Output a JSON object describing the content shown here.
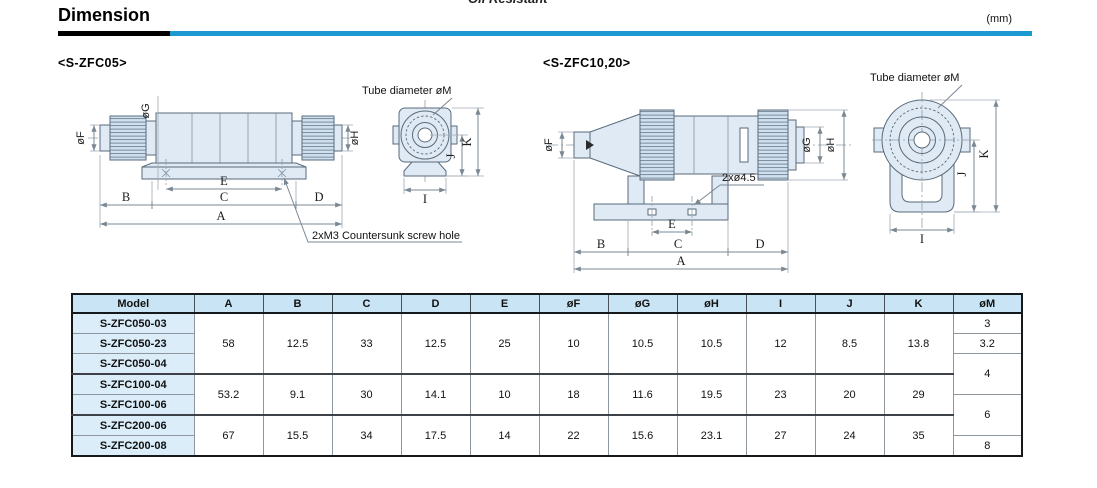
{
  "page": {
    "title": "Dimension",
    "unit": "(mm)",
    "cropped_text": "Oil Resistant"
  },
  "drawings": {
    "left": {
      "title": "<S-ZFC05>",
      "note": "2xM3 Countersunk screw hole",
      "tube_caption": "Tube diameter øM"
    },
    "right": {
      "title": "<S-ZFC10,20>",
      "note": "2xø4.5",
      "tube_caption": "Tube diameter øM"
    },
    "dim_labels": {
      "a": "A",
      "b": "B",
      "c": "C",
      "d": "D",
      "e": "E",
      "f": "øF",
      "g": "øG",
      "h": "øH",
      "i": "I",
      "j": "J",
      "k": "K"
    }
  },
  "table": {
    "headers": [
      "Model",
      "A",
      "B",
      "C",
      "D",
      "E",
      "øF",
      "øG",
      "øH",
      "I",
      "J",
      "K",
      "øM"
    ],
    "models": [
      "S-ZFC050-03",
      "S-ZFC050-23",
      "S-ZFC050-04",
      "S-ZFC100-04",
      "S-ZFC100-06",
      "S-ZFC200-06",
      "S-ZFC200-08"
    ],
    "groups": [
      {
        "A": "58",
        "B": "12.5",
        "C": "33",
        "D": "12.5",
        "E": "25",
        "F": "10",
        "G": "10.5",
        "H": "10.5",
        "I": "12",
        "J": "8.5",
        "K": "13.8"
      },
      {
        "A": "53.2",
        "B": "9.1",
        "C": "30",
        "D": "14.1",
        "E": "10",
        "F": "18",
        "G": "11.6",
        "H": "19.5",
        "I": "23",
        "J": "20",
        "K": "29"
      },
      {
        "A": "67",
        "B": "15.5",
        "C": "34",
        "D": "17.5",
        "E": "14",
        "F": "22",
        "G": "15.6",
        "H": "23.1",
        "I": "27",
        "J": "24",
        "K": "35"
      }
    ],
    "m_values": [
      "3",
      "3.2",
      "4",
      "6",
      "8"
    ]
  },
  "colors": {
    "accent_blue": "#1b9ad2",
    "table_header_bg": "#c9e5f5",
    "model_cell_bg": "#daedf9",
    "drawing_fill": "#dfeaf4",
    "drawing_outline": "#5a6b7c"
  }
}
